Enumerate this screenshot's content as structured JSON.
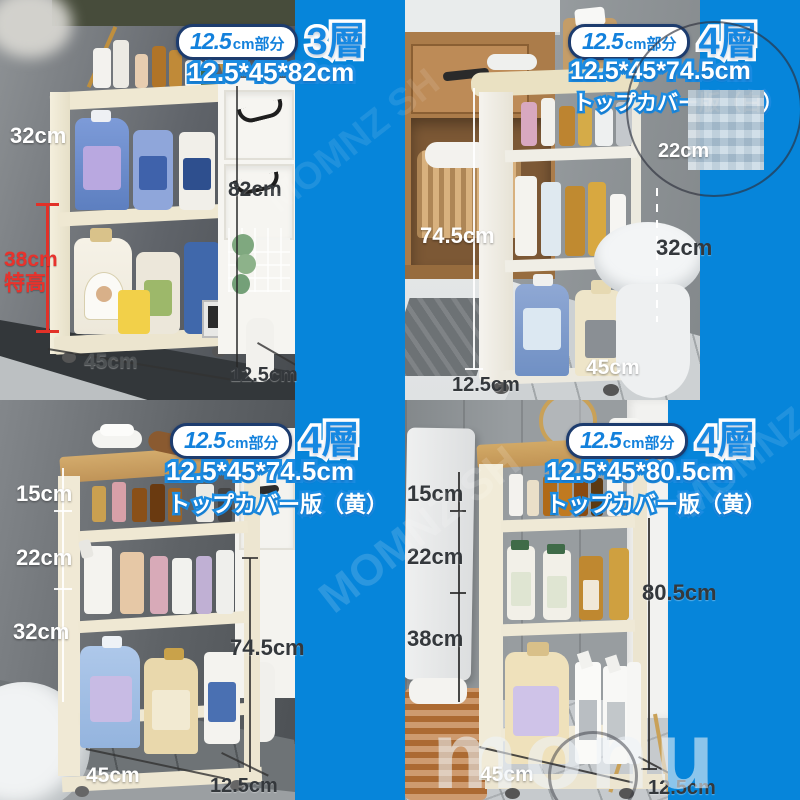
{
  "colors": {
    "background_blue": "#0685da",
    "label_blue": "#1688e2",
    "pill_border_navy": "#1d3c6e",
    "highlight_red": "#e8322c",
    "cart_cream": "#f0e9d5",
    "wood_top": "#c9a365"
  },
  "watermark": {
    "brand": "monu",
    "diagonal": "MOMNZ SH"
  },
  "quadrants": [
    {
      "id": "top-left",
      "pill_number": "12.5",
      "pill_suffix": "cm部分",
      "tier": "3層",
      "size": "12.5*45*82cm",
      "subtitle": "",
      "dims": {
        "side": "32cm",
        "red": "38cm\n特高",
        "height": "82cm",
        "width": "45cm",
        "depth": "12.5cm"
      }
    },
    {
      "id": "top-right",
      "pill_number": "12.5",
      "pill_suffix": "cm部分",
      "tier": "4層",
      "size": "12.5*45*74.5cm",
      "subtitle": "トップカバー版（白）",
      "dims": {
        "height": "74.5cm",
        "upper": "22cm",
        "lower": "32cm",
        "width": "45cm",
        "depth": "12.5cm"
      }
    },
    {
      "id": "bottom-left",
      "pill_number": "12.5",
      "pill_suffix": "cm部分",
      "tier": "4層",
      "size": "12.5*45*74.5cm",
      "subtitle": "トップカバー版（黄）",
      "dims": {
        "t1": "15cm",
        "t2": "22cm",
        "t3": "32cm",
        "height": "74.5cm",
        "width": "45cm",
        "depth": "12.5cm"
      }
    },
    {
      "id": "bottom-right",
      "pill_number": "12.5",
      "pill_suffix": "cm部分",
      "tier": "4層",
      "size": "12.5*45*80.5cm",
      "subtitle": "トップカバー版（黄）",
      "dims": {
        "t1": "15cm",
        "t2": "22cm",
        "t3": "38cm",
        "height": "80.5cm",
        "width": "45cm",
        "depth": "12.5cm"
      }
    }
  ]
}
